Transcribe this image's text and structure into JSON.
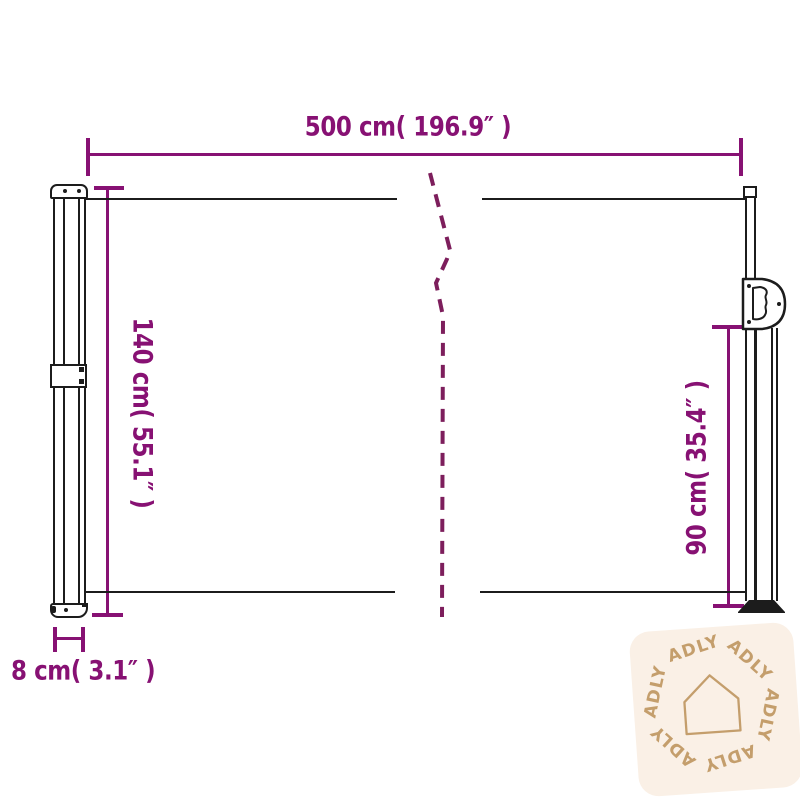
{
  "diagram": {
    "product": "retractable-side-awning-dimension-diagram",
    "dimensions": {
      "width": "500 cm( 196.9″ )",
      "height_left": "140 cm( 55.1″ )",
      "height_right": "90 cm( 35.4″ )",
      "depth": "8 cm( 3.1″ )"
    }
  },
  "watermark": {
    "brand": "ADLY",
    "icon": "house-icon",
    "repeat_count": 6
  },
  "colors": {
    "dim": "#871173",
    "dash": "#7d1e5c",
    "ink": "#1c1c1c",
    "wm-bg": "#faf0e6",
    "wm-fg": "#c49e6c"
  }
}
